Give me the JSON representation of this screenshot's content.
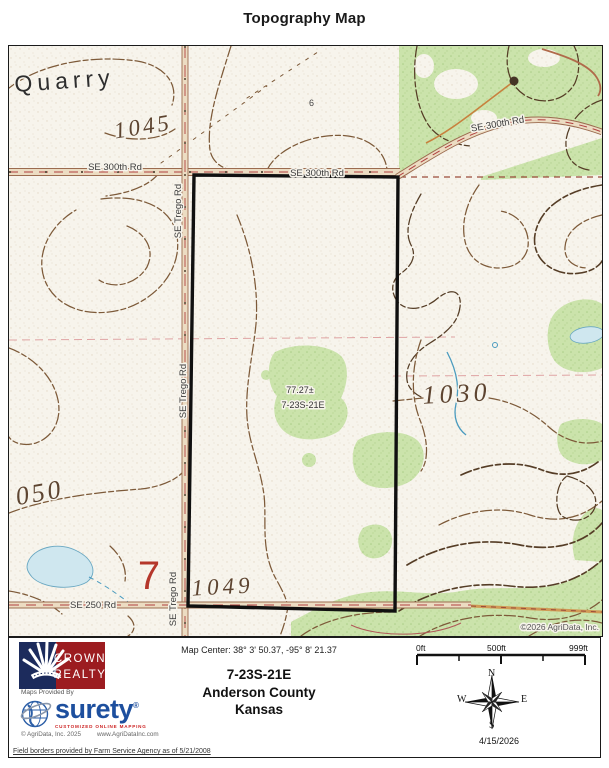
{
  "title": "Topography Map",
  "map": {
    "labels": {
      "quarry": "Quarry",
      "contour_1045": "1045",
      "spot_6": "6",
      "road_se_300th_west": "SE 300th Rd",
      "road_se_300th_mid": "SE 300th Rd",
      "road_se_300th_diag": "SE 300th Rd",
      "road_se_trego_top": "SE Trego Rd",
      "road_se_trego_mid": "SE Trego Rd",
      "road_se_trego_bottom": "SE Trego Rd",
      "road_se_250": "SE 250 Rd",
      "parcel_acreage": "77.27±",
      "parcel_section": "7-23S-21E",
      "contour_1030": "1030",
      "contour_1050_partial": "050",
      "contour_1049": "1049",
      "section_number": "7",
      "copyright": "©2026 AgriData, Inc."
    },
    "colors": {
      "paper": "#f7f4ec",
      "contour": "#7d5a39",
      "contour_dark": "#553d26",
      "vegetation_green": "#cbe3ab",
      "water_fill": "#cfe7ef",
      "water_line": "#6aa8c2",
      "road_fill": "#ecdcc2",
      "road_edge": "#9b6b4f",
      "road_centerline_red": "#b04040",
      "parcel_boundary": "#101010",
      "section_number_red": "#b5372b"
    }
  },
  "footer": {
    "brand": {
      "crown_line1": "CROWN",
      "crown_line2": "REALTY",
      "maps_provided_by": "Maps Provided By",
      "surety": "surety",
      "surety_reg": "®",
      "surety_tagline": "CUSTOMIZED ONLINE MAPPING",
      "agridata_copyright": "© AgriData, Inc. 2025",
      "agridata_url": "www.AgriDataInc.com",
      "crown_navy": "#1c2b5c",
      "crown_red": "#9c1c20",
      "surety_blue": "#1d4f9e"
    },
    "map_center": "Map Center: 38° 3' 50.37,  -95° 8' 21.37",
    "location": {
      "trs": "7-23S-21E",
      "county": "Anderson County",
      "state": "Kansas"
    },
    "scale": {
      "t0": "0ft",
      "t1": "500ft",
      "t2": "999ft"
    },
    "compass": {
      "n": "N",
      "e": "E",
      "s": "S",
      "w": "W"
    },
    "date": "4/15/2026",
    "disclaimer": "Field borders provided by Farm Service Agency as of 5/21/2008"
  }
}
